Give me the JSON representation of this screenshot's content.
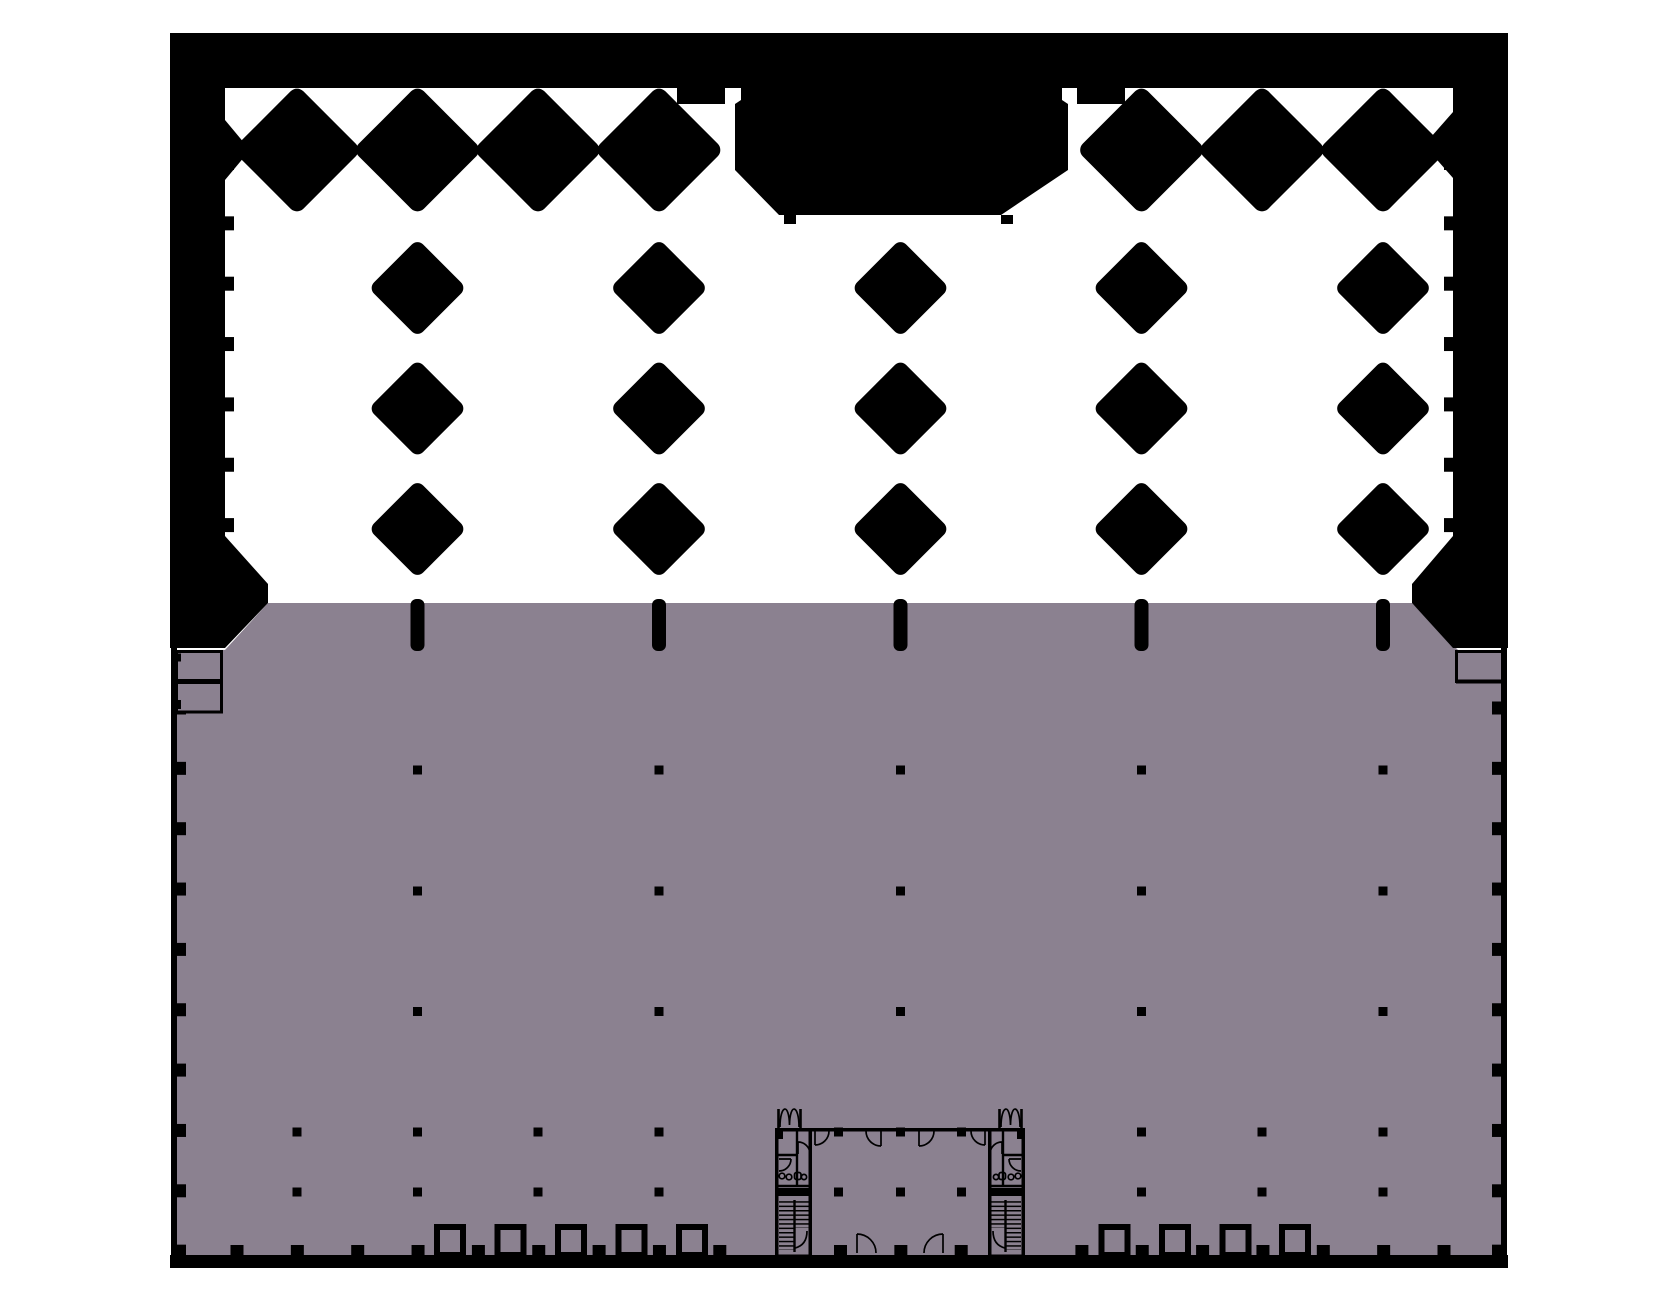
{
  "drawing": {
    "kind": "architectural-floor-plan",
    "upper_zone": "open void with diamond-shaped columns on white",
    "lower_zone": "floor slab shaded mauve with column-dot grid and two stair cores"
  },
  "colors": {
    "background": "#ffffff",
    "structure": "#000000",
    "floor": "#8b8190"
  },
  "plan": {
    "outline": {
      "left": 170,
      "right": 1508,
      "top": 33,
      "band_bottom": 88,
      "slab_top": 603,
      "slab_bottom": 1255,
      "base_band_bottom": 1268
    },
    "columns_main": [
      417.5,
      659,
      900.5,
      1141.5,
      1383
    ],
    "columns_half": [
      297,
      417.5,
      538,
      659,
      780,
      900.5,
      1021,
      1141.5,
      1262,
      1383
    ],
    "row1_diamonds": {
      "y": 150,
      "side": 92,
      "radius": 9,
      "skip": [
        780,
        900.5,
        1021
      ]
    },
    "free_diamond_rows": [
      288,
      408.5,
      529
    ],
    "free_diamond_side": 69.5,
    "free_diamond_radius": 8,
    "edge_marks": {
      "y": 599,
      "w": 14,
      "h": 52,
      "r": 6
    },
    "dots": {
      "size": 9,
      "rows_main": [
        770,
        891,
        1011.5
      ],
      "rows_half": [
        1132,
        1192
      ],
      "skip_half": [
        780,
        1021
      ],
      "core_extra_columns": [
        838.5,
        961.5
      ]
    },
    "bottom_ticks": {
      "start": 237,
      "step": 60.35,
      "count": 21,
      "skip_idx": [
        9,
        13
      ],
      "w": 13,
      "h": 10,
      "y": 1245
    },
    "door_squares": {
      "w": 26,
      "h": 28,
      "y": 1227,
      "stroke": 6,
      "left_centers": [
        450,
        510.5,
        571,
        631.5,
        692
      ],
      "right_centers": [
        1114.5,
        1175,
        1235.5,
        1295
      ]
    },
    "wall_nubs": {
      "upper": {
        "y0": 163,
        "step": 60.35,
        "count": 7,
        "w": 9,
        "h": 14,
        "left_x": 225,
        "right_x": 1444
      },
      "lower": {
        "y0": 708,
        "step": 60.35,
        "count": 10,
        "w": 9,
        "h": 13,
        "left_x": 177,
        "right_x": 1492
      }
    }
  }
}
